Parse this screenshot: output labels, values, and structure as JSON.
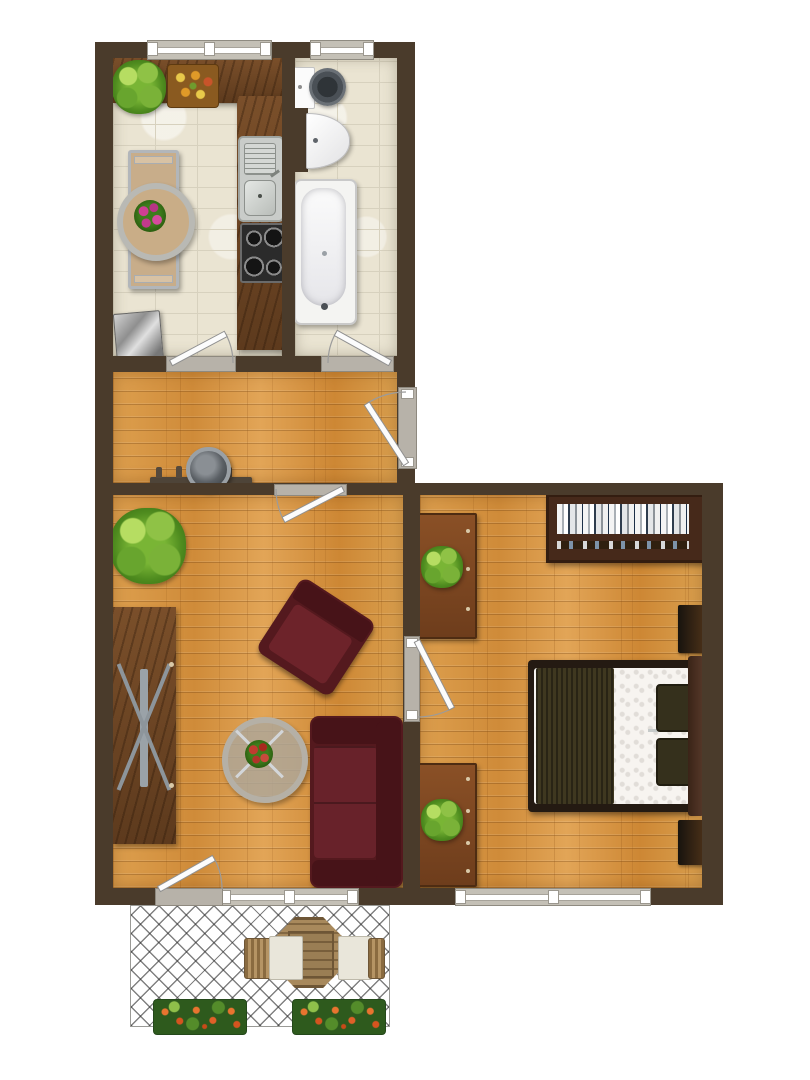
{
  "meta": {
    "title": "apartment floor plan",
    "view": "top-down rendered color plan",
    "rooms_count": 6
  },
  "palette": {
    "wall": "#4a3b2b",
    "tile_floor": "#eae4d2",
    "tile_grout": "#d7d1be",
    "wood_floor": "#d6953f",
    "walnut_furniture": "#6b4423",
    "upholstery_red": "#54191e",
    "bed_blanket_olive": "#3f3820",
    "bedroom_chest_brown": "#8a5026",
    "plant_green": "#4f8c1f",
    "fixture_white": "#ffffff",
    "frame_gray": "#b7b2a9",
    "lattice_line": "#2d2d2d"
  },
  "rooms": [
    {
      "name": "kitchen",
      "floor": "cream tile",
      "items": [
        "L-shaped walnut counter",
        "double stainless sink",
        "cooktop with 4 burners",
        "dining table",
        "round centerpiece with flower bouquet",
        "potted plant on counter",
        "fruit tray",
        "metal bin"
      ]
    },
    {
      "name": "bathroom",
      "floor": "cream tile",
      "items": [
        "toilet with tank",
        "half-round washbasin",
        "bathtub with faucet"
      ]
    },
    {
      "name": "hallway",
      "floor": "wood parquet",
      "items": [
        "wall coat rack with hooks",
        "decorative metal bowl"
      ]
    },
    {
      "name": "living room",
      "floor": "wood parquet",
      "items": [
        "sideboard with X-frame front",
        "potted plant",
        "armchair",
        "round glass coffee table with red bouquet",
        "three-seat sofa"
      ]
    },
    {
      "name": "bedroom",
      "floor": "wood parquet",
      "items": [
        "bookshelf with books",
        "chest of drawers with plant (upper)",
        "chest of drawers with plant (lower)",
        "double bed with olive blanket and two pillows",
        "headboard",
        "nightstand (upper)",
        "nightstand (lower)"
      ]
    },
    {
      "name": "balcony",
      "floor": "lattice deck",
      "items": [
        "octagonal wooden table",
        "left chair",
        "right chair",
        "left flower box",
        "right flower box"
      ]
    }
  ],
  "openings": {
    "windows": [
      {
        "room": "kitchen",
        "wall": "top",
        "panes": 2
      },
      {
        "room": "bathroom",
        "wall": "top",
        "panes": 1
      },
      {
        "room": "living room",
        "wall": "bottom",
        "panes": 2
      },
      {
        "room": "bedroom",
        "wall": "bottom",
        "panes": 2
      }
    ],
    "doors": [
      {
        "from": "hallway",
        "to": "kitchen",
        "swing": "into kitchen"
      },
      {
        "from": "hallway",
        "to": "bathroom",
        "swing": "into bathroom"
      },
      {
        "from": "outside",
        "to": "hallway",
        "note": "entrance door, right wall"
      },
      {
        "from": "hallway",
        "to": "living room",
        "swing": "into living room"
      },
      {
        "from": "living room",
        "to": "bedroom",
        "swing": "into bedroom"
      },
      {
        "from": "living room",
        "to": "balcony",
        "swing": "into living room"
      }
    ]
  }
}
